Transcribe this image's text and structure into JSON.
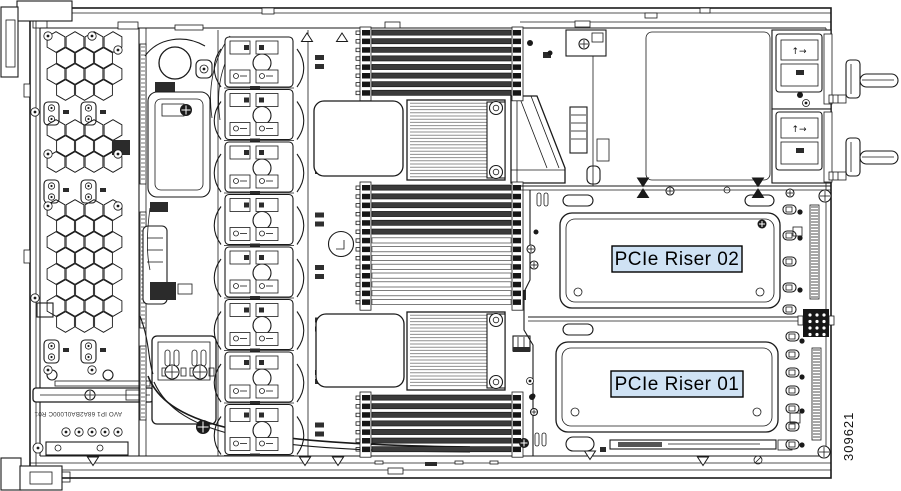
{
  "figure": {
    "type": "server-chassis-top-view-diagram",
    "labels": {
      "riser02": "PCIe Riser 02",
      "riser01": "PCIe Riser 01",
      "figure_number": "309621",
      "board_marking": "AVO IP1 68A2BA0L000C R01",
      "psu_airflow_arrows": "↑→"
    },
    "colors": {
      "line": "#1a1a1a",
      "label_fill": "#cfe2f4",
      "label_border": "#000000",
      "dimm_dark": "#3b3b3b",
      "fin_gray": "#8f8f8f",
      "background": "#ffffff"
    },
    "counts": {
      "fan_modules": 8,
      "dimm_bank_top_slots": 8,
      "dimm_bank_middle_slots": 14,
      "dimm_bank_middle_populated": 6,
      "dimm_bank_bottom_slots": 7,
      "rear_io_slots_upper": 5,
      "rear_io_slots_lower": 7,
      "psu_modules": 2
    }
  }
}
